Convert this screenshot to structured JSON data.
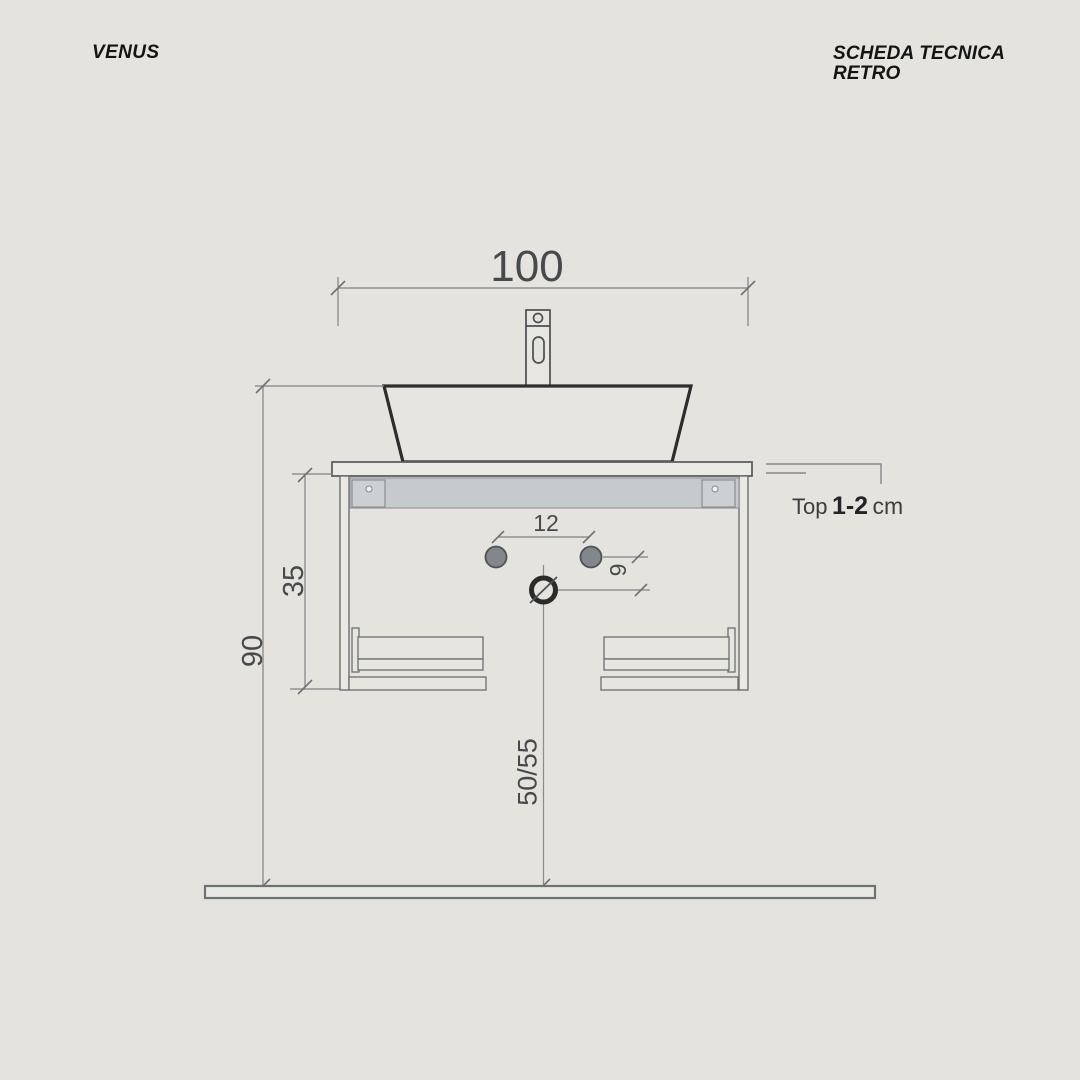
{
  "header": {
    "brand": "VENUS",
    "title_line1": "SCHEDA TECNICA",
    "title_line2": "RETRO"
  },
  "drawing": {
    "dimensions": {
      "overall_width": "100",
      "supply_holes_spacing": "12",
      "drain_offset": "9",
      "cabinet_height": "35",
      "basin_rim_height": "90",
      "drain_height": "50/55"
    },
    "callout": {
      "label": "Top",
      "value": "1-2",
      "unit": "cm"
    }
  },
  "colors": {
    "background": "#e4e3de",
    "dimension_lines": "#7f8184",
    "outline": "#63666a",
    "basin_stroke": "#2d2d2d",
    "rail_fill": "#c7cacd",
    "hole_fill": "#83868a",
    "text_dark": "#202022",
    "text_dim": "#48494c"
  }
}
